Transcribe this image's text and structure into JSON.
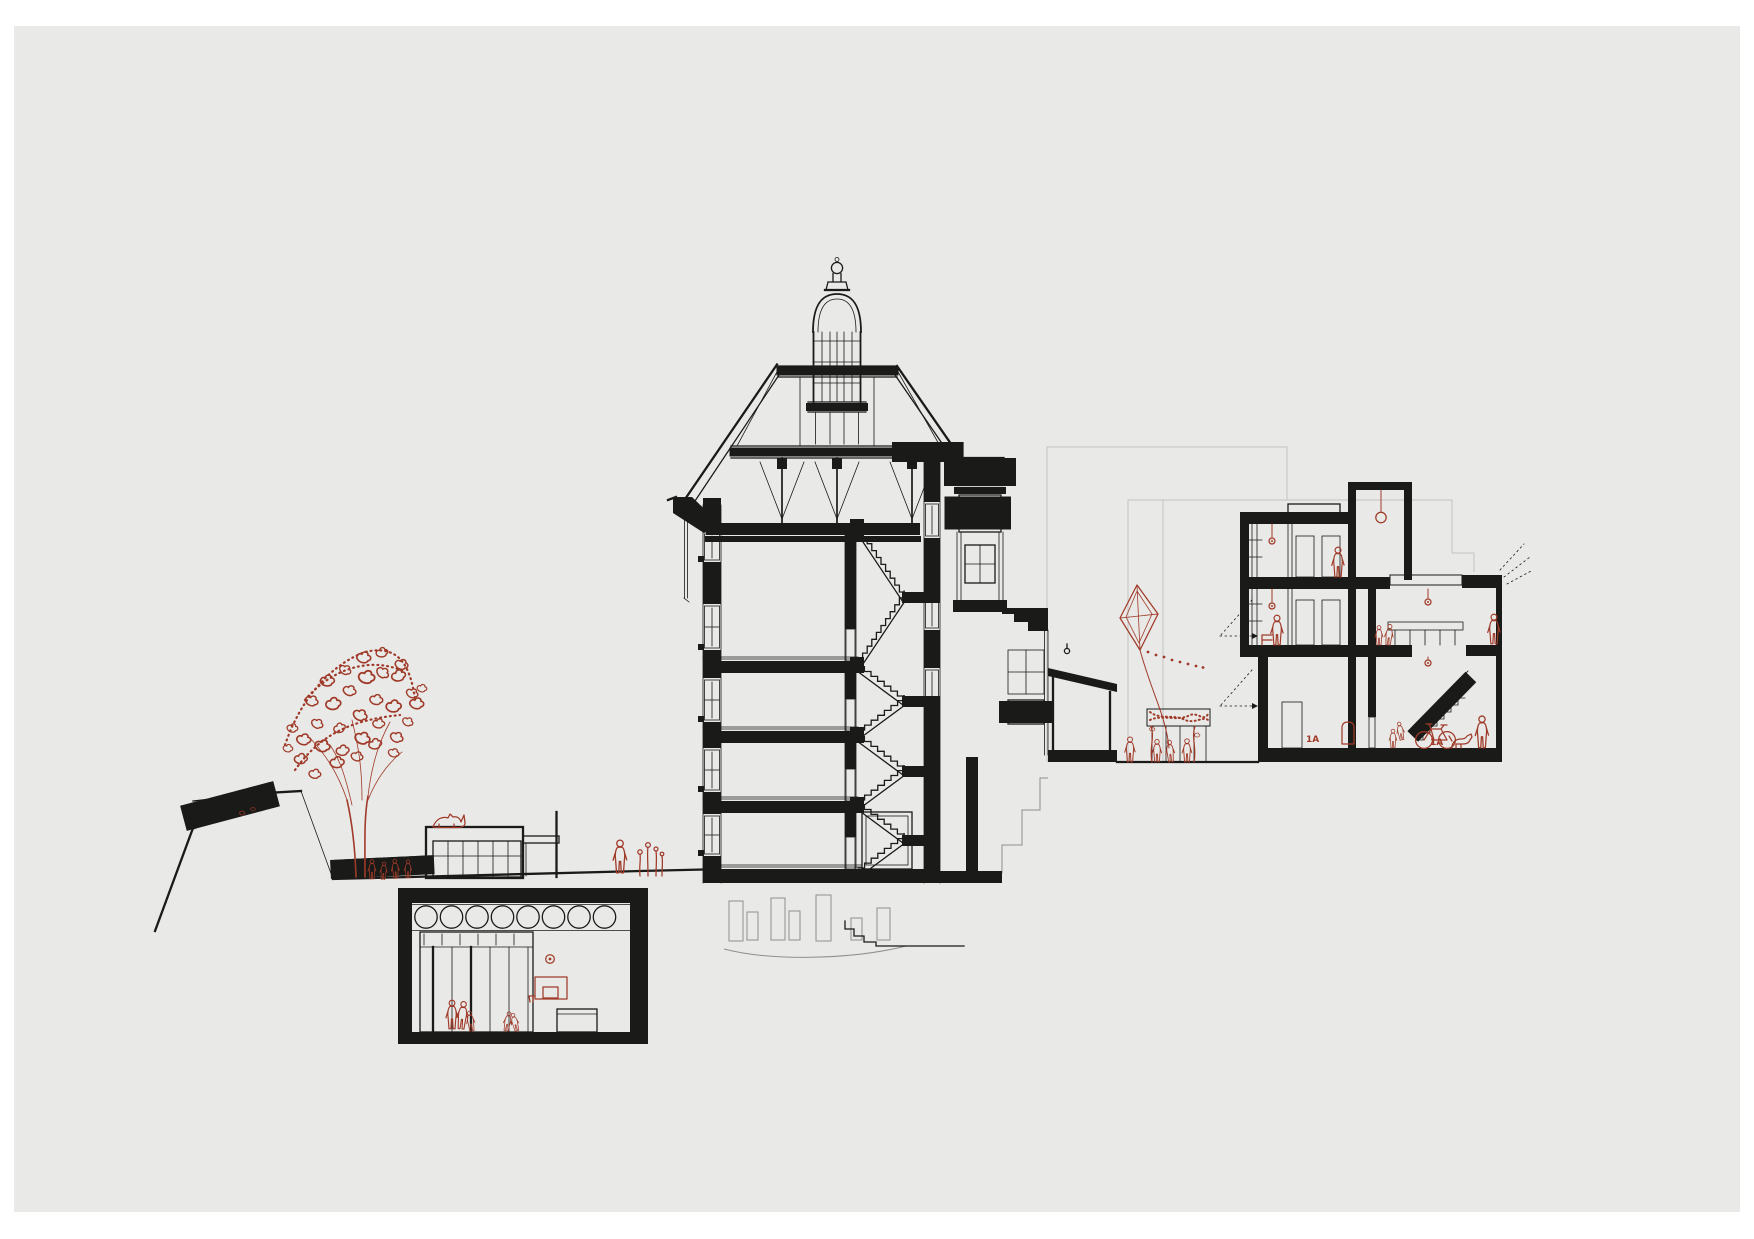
{
  "palette": {
    "paper": "#e9e9e8",
    "ink": "#1a1a18",
    "red": "#a03a28",
    "faint": "#c3c3c1",
    "gray": "#8f8f8d"
  },
  "labels": {
    "room_1a_ground_left": "1A",
    "room_1a_ground_right": "1A"
  },
  "drawing": {
    "type": "architectural-cross-section",
    "buildings": [
      {
        "name": "main-historic-building",
        "features": [
          "cupola-lantern",
          "timber-roof-truss",
          "dentil-cornice",
          "switchback-staircase",
          "bay-window-tower",
          "entry-porch"
        ]
      },
      {
        "name": "new-school-wing",
        "features": [
          "flat-roof",
          "roof-skylights",
          "two-classroom-floors",
          "double-height-hall",
          "balustrade-stair",
          "pendant-lamp"
        ]
      },
      {
        "name": "underground-gymnasium",
        "features": [
          "round-clerestory-windows",
          "glazed-partition",
          "basketball-hoop",
          "bench"
        ]
      },
      {
        "name": "garden-pavilion",
        "features": [
          "glazed-front",
          "flat-roof"
        ]
      }
    ],
    "red_accents": [
      "tree",
      "children-at-fence",
      "cat-on-pavilion-roof",
      "person-by-flowers",
      "gym-players",
      "basketball",
      "basketball-hoop",
      "kite",
      "kite-string",
      "pergola-vines",
      "courtyard-children",
      "classroom-figures",
      "ceiling-lamps",
      "pendant-lamp",
      "picture-frame",
      "children-on-stair",
      "bicycle",
      "dog",
      "standing-person"
    ],
    "gym_clerestory_circle_count": 8
  }
}
